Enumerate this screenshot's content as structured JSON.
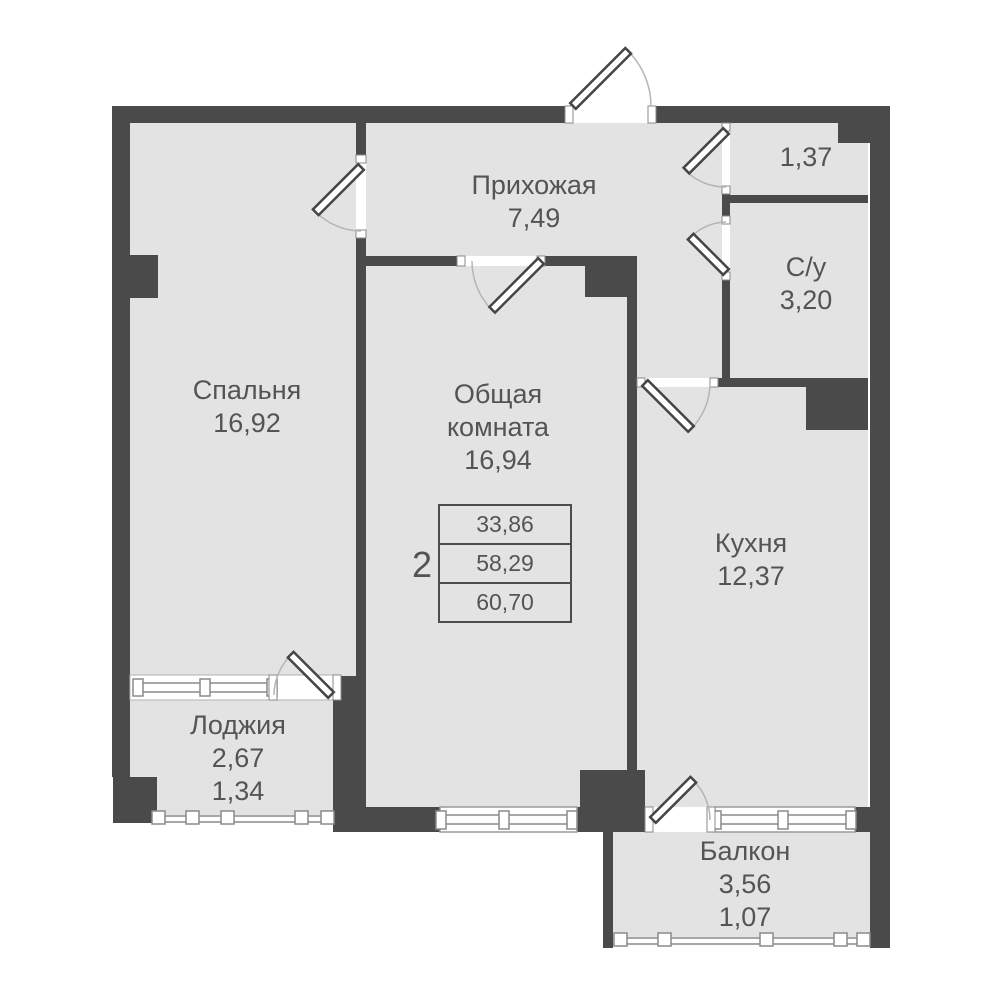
{
  "rooms": {
    "hallway": {
      "name": "Прихожая",
      "area": "7,49"
    },
    "storage": {
      "area": "1,37"
    },
    "bathroom": {
      "name": "С/у",
      "area": "3,20"
    },
    "bedroom": {
      "name": "Спальня",
      "area": "16,92"
    },
    "living": {
      "name_line1": "Общая",
      "name_line2": "комната",
      "area": "16,94"
    },
    "kitchen": {
      "name": "Кухня",
      "area": "12,37"
    },
    "loggia": {
      "name": "Лоджия",
      "area": "2,67",
      "reduced_area": "1,34"
    },
    "balcony": {
      "name": "Балкон",
      "area": "3,56",
      "reduced_area": "1,07"
    }
  },
  "summary": {
    "rooms_count": "2",
    "living_area": "33,86",
    "apartment_area": "58,29",
    "total_area": "60,70"
  },
  "colors": {
    "wall": "#4a4a4a",
    "floor": "#e3e3e3",
    "text": "#545454",
    "window_line": "#8a8a8a",
    "arc_line": "#b5b5b5"
  }
}
